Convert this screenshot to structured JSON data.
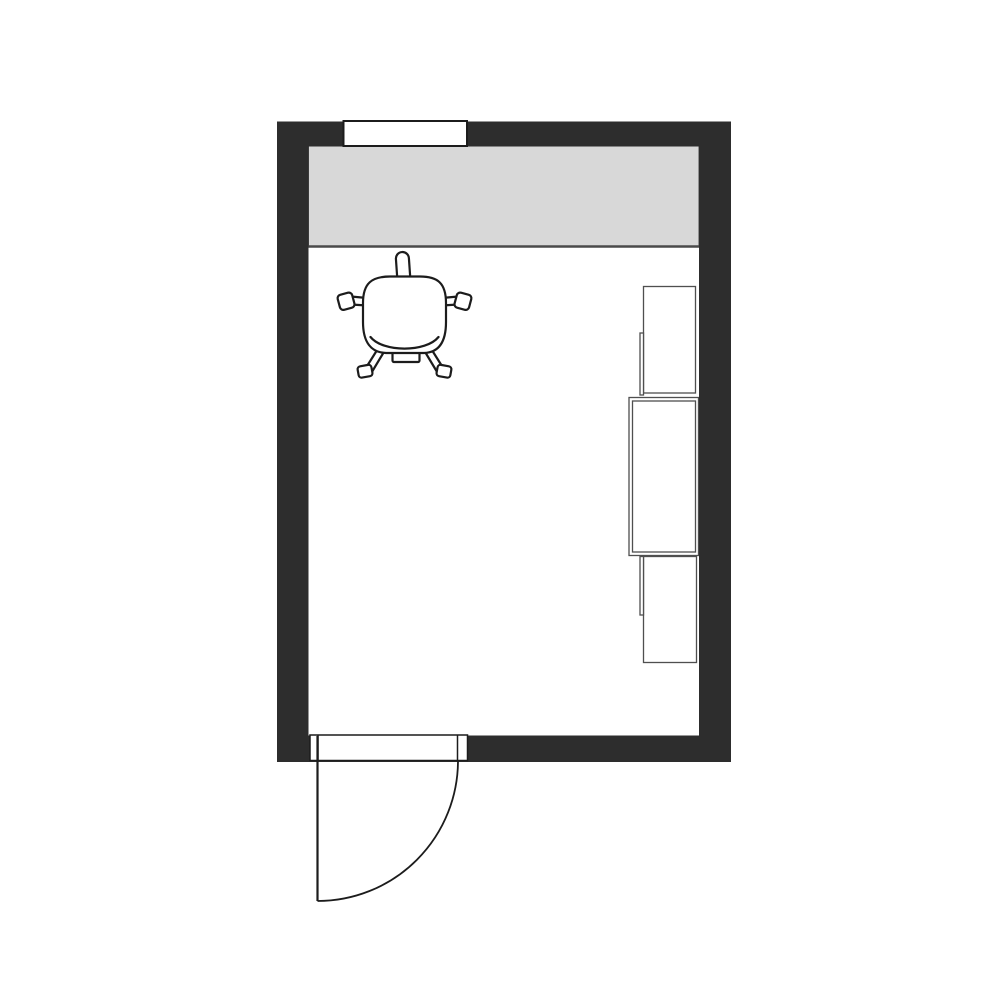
{
  "canvas": {
    "background": "#ffffff",
    "kind": "floor-plan"
  },
  "palette": {
    "wall": "#2d2d2d",
    "floor": "#ffffff",
    "counter": "#d8d8d8",
    "counter_edge": "#4a4a4a",
    "outline": "#1c1c1c",
    "cabinet_line": "#4f4f4f"
  },
  "objects": {
    "room": {
      "name": "room",
      "walls": [
        "top",
        "right",
        "bottom",
        "left"
      ]
    },
    "window": {
      "name": "window",
      "wall": "top"
    },
    "counter": {
      "name": "counter-worktop",
      "against_wall": "top"
    },
    "chair": {
      "name": "office-chair",
      "parts": [
        "headrest",
        "armrest-left",
        "armrest-right",
        "seat",
        "leg-left",
        "leg-right",
        "casters",
        "base-hub"
      ]
    },
    "cabinets": [
      {
        "name": "cabinet-upper",
        "wall": "right"
      },
      {
        "name": "cabinet-middle",
        "wall": "right"
      },
      {
        "name": "cabinet-lower",
        "wall": "right"
      }
    ],
    "door": {
      "name": "door",
      "wall": "bottom",
      "parts": [
        "frame",
        "jamb-left",
        "jamb-right",
        "leaf",
        "swing-arc"
      ]
    }
  }
}
